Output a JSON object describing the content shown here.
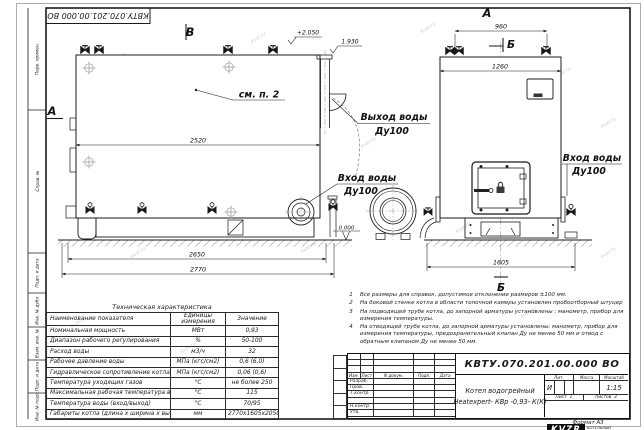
{
  "sheet": {
    "stamp_top": "КВТУ.070.201.00.000  ВО",
    "format_label": "Формат  А3",
    "watermark": "kvzr.ru",
    "margin_labels": [
      "Перв. примен.",
      "Справ. №",
      "Подп. и дата",
      "Инв. № дубл.",
      "Взам. инв. №",
      "Подп. и дата",
      "Инв. № подл."
    ]
  },
  "drawing": {
    "view_b": "В",
    "view_a_side": "А",
    "view_a_front": "А",
    "section_b_top": "Б",
    "section_b_bottom": "Б",
    "see_note": "см. п. 2",
    "elev_top": "+2.050",
    "elev_outlet": "1.930",
    "elev_zero": "0.000",
    "dim_2520": "2520",
    "dim_2650": "2650",
    "dim_2770": "2770",
    "dim_960": "960",
    "dim_1260": "1260",
    "dim_1605": "1605",
    "label_out_1": "Выход воды",
    "label_out_2": "Ду100",
    "label_in_left_1": "Вход воды",
    "label_in_left_2": "Ду100",
    "label_in_right_1": "Вход воды",
    "label_in_right_2": "Ду100"
  },
  "table": {
    "title": "Техническая характеристика",
    "headers": [
      "Наименование показателя",
      "Единицы измерения",
      "Значение"
    ],
    "rows": [
      [
        "Номинальная мощность",
        "МВт",
        "0,93"
      ],
      [
        "Диапазон рабочего регулирования",
        "%",
        "50-100"
      ],
      [
        "Расход воды",
        "м3/ч",
        "32"
      ],
      [
        "Рабочее давление воды",
        "МПа (кгс/см2)",
        "0,6 (6,0)"
      ],
      [
        "Гидравлическое сопротивление котла",
        "МПа (кгс/см2)",
        "0,06 (0,6)"
      ],
      [
        "Температура уходящих газов",
        "°С",
        "не более 250"
      ],
      [
        "Максимальная рабочая температура воды",
        "°С",
        "115"
      ],
      [
        "Температура воды (вход/выход)",
        "°С",
        "70/95"
      ],
      [
        "Габариты котла (длина х ширина х высота)",
        "мм",
        "2770х1605х2050"
      ]
    ]
  },
  "notes": [
    {
      "num": "1",
      "text": "Все размеры для справок, допустимое отклонение размеров ±100 мм."
    },
    {
      "num": "2",
      "text": "На боковой стенке котла в области топочной камеры установлен пробоотборный штуцер"
    },
    {
      "num": "3",
      "text": "На подводящей трубе котла, до запорной арматуры установлены : манометр, прибор для измерения температуры."
    },
    {
      "num": "4",
      "text": "На отводящей трубе котла, до запорной арматуры установлены: манометр, прибор для измерения температуры, предохранительный клапан Ду не менее 50 мм и отвод с обратным клапаном Ду не менее 50 мм."
    }
  ],
  "titleblock": {
    "doc_number": "КВТУ.070.201.00.000  ВО",
    "name_line1": "Котел водогрейный",
    "name_line2": "Heatexpert- КВр -0,93- К(К)",
    "col_izm": "Изм.",
    "col_list": "Лист",
    "col_ndoc": "N докум.",
    "col_podp": "Подп.",
    "col_data": "Дата",
    "row_razrab": "Разраб.",
    "row_prov": "Пров.",
    "row_tkontr": "Т.контр.",
    "row_nkontr": "Н.контр.",
    "row_utv": "Утв.",
    "lit_header": "Лит.",
    "mass_header": "Масса",
    "scale_header": "Масштаб",
    "lit_value": "И",
    "scale_value": "1:15",
    "sheet_label": "Лист",
    "sheet_value": "1",
    "sheets_label": "Листов",
    "sheets_value": "2",
    "logo": "KVZR",
    "company_line1": "КОТЕЛЬНЫЙ",
    "company_line2": "ЗАВОД РЭП"
  }
}
